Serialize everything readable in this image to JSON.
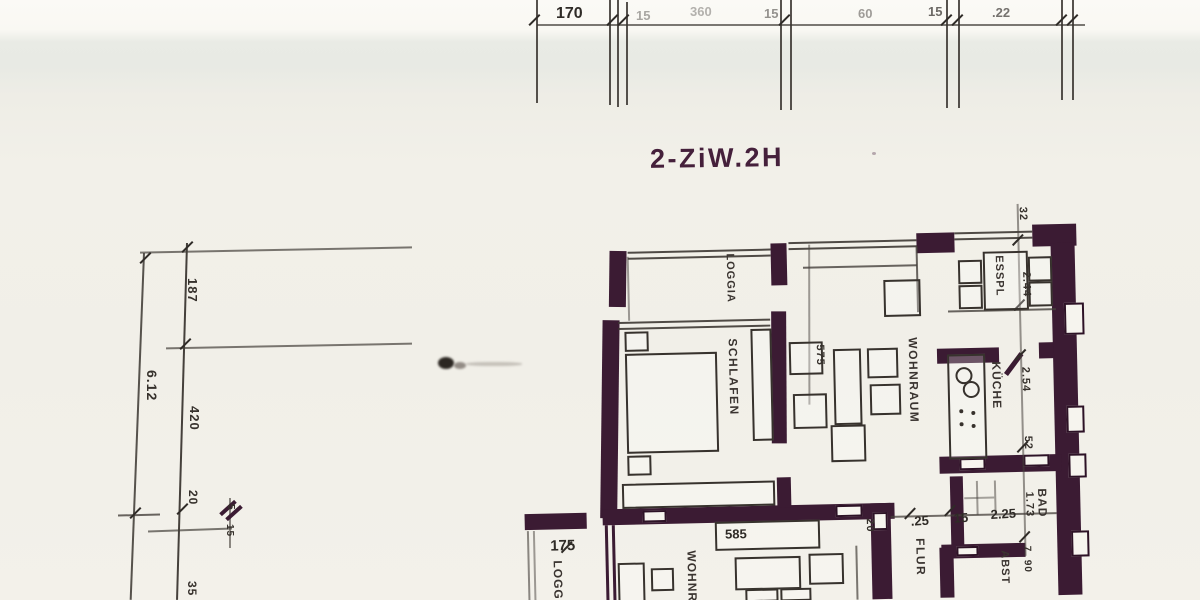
{
  "title": "2-ZiW.2H",
  "colors": {
    "wall": "#3b1b33",
    "ink": "#36312c",
    "paper": "#f2f0e9"
  },
  "rooms": {
    "loggia": "LOGGIA",
    "schlafen": "SCHLAFEN",
    "wohnraum": "WOHNRAUM",
    "esspl": "ESSPL",
    "kueche": "KÜCHE",
    "bad": "BAD",
    "flur": "FLUR",
    "abst": "ABST",
    "wohnr": "WOHNR",
    "loggia2": "LOGGIA"
  },
  "top_dims": {
    "d170": "170",
    "d15a": "15",
    "d360": "360",
    "d15b": "15",
    "d60": "60",
    "d15c": "15",
    "d22": ".22"
  },
  "left_dims": {
    "d187": "187",
    "d420": "420",
    "d20": "20",
    "d5": "5",
    "d15": "15",
    "d35": "35",
    "d612": "6.12"
  },
  "right_dims": {
    "d32": "32",
    "d244": "2.44",
    "d254": "2.54",
    "d52": "52",
    "d173": "1.73"
  },
  "flur_dims": {
    "d20": "20",
    "d25": ".25",
    "d15": "15",
    "d225": "2.25",
    "d7": "7",
    "d90": "90"
  },
  "furniture_dims": {
    "d575": "575",
    "d585": "585",
    "d175": "175"
  }
}
